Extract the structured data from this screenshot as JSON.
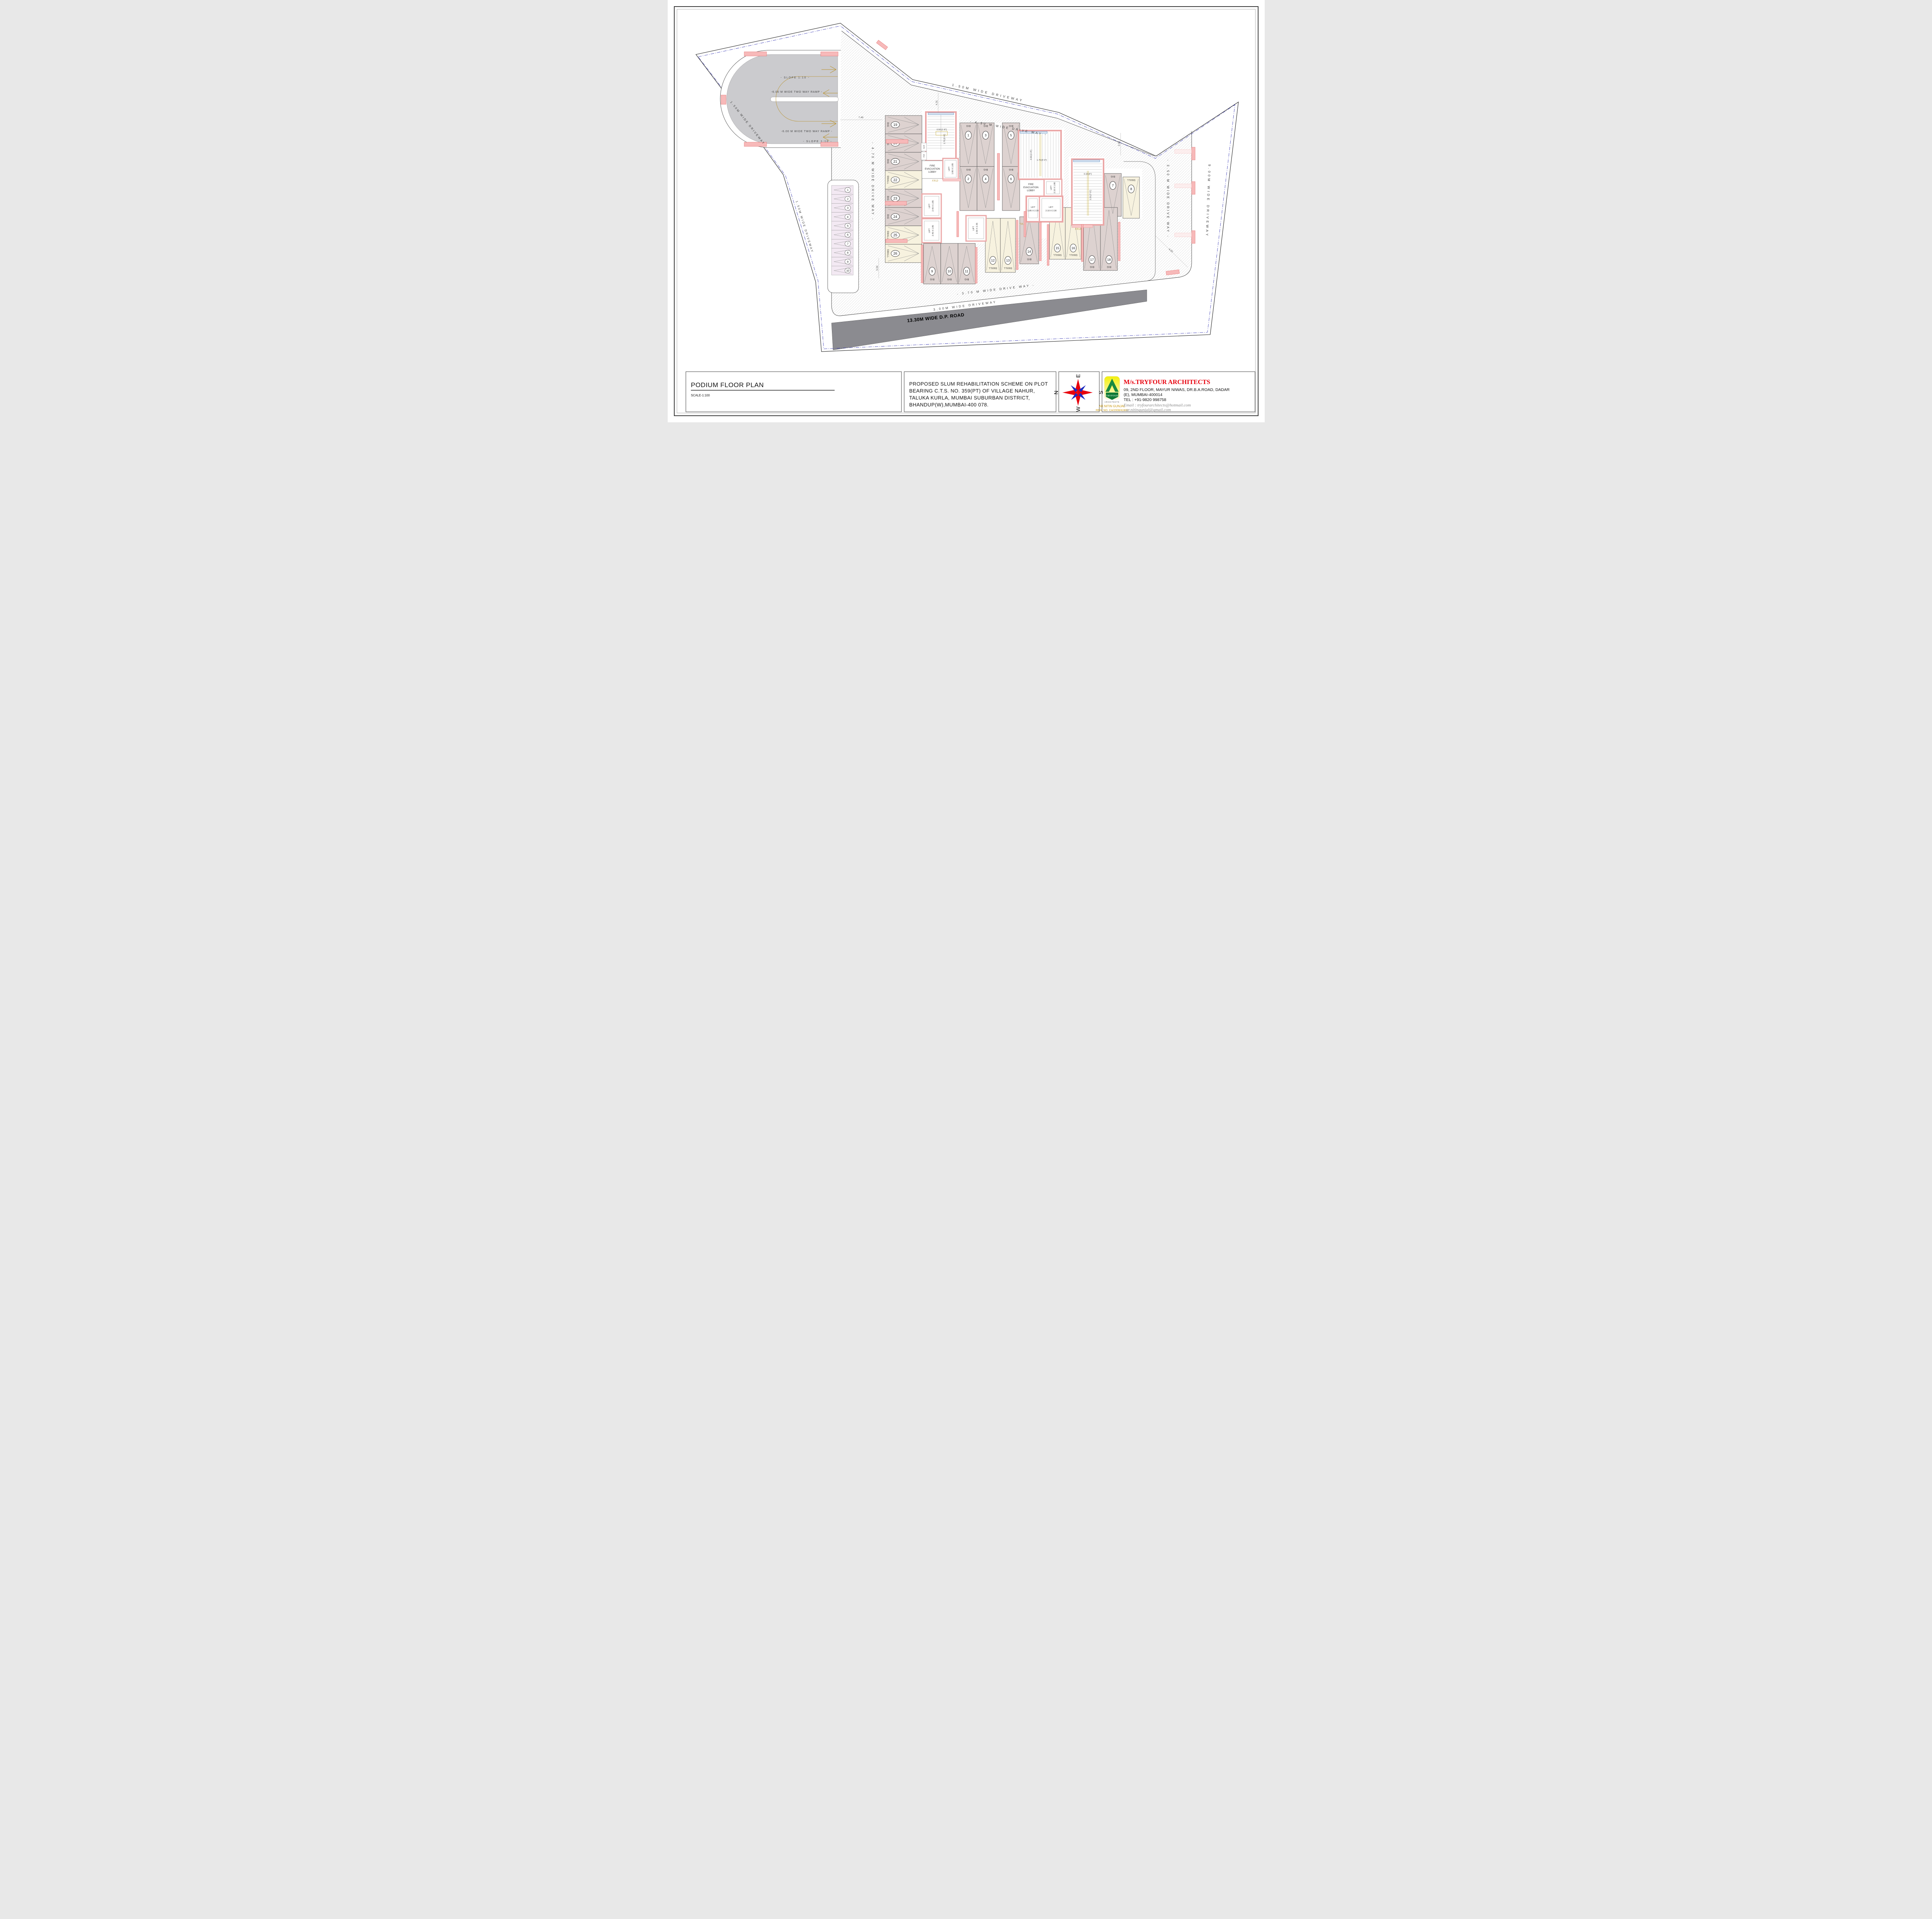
{
  "drawing": {
    "title": "PODIUM FLOOR PLAN",
    "scale": "SCALE-1:100",
    "description_lines": [
      "PROPOSED SLUM REHABILITATION SCHEME ON PLOT",
      "BEARING C.T.S. NO. 359(PT) OF VILLAGE NAHUR,",
      "TALUKA KURLA, MUMBAI SUBURBAN DISTRICT,",
      "BHANDUP(W),MUMBAI-400 078."
    ],
    "compass": {
      "n": "N",
      "e": "E",
      "s": "S",
      "w": "W"
    },
    "architect": {
      "firm": "M/s.TRYFOUR ARCHITECTS",
      "address1": "09, 2ND FLOOR, MAYUR NIWAS, DR.B.A.ROAD, DADAR",
      "address2": "(E), MUMBAI-400014",
      "tel": "TEL        : +91-9820 998758",
      "email1": "Email      : tryfourarchitects@hotmail.com",
      "email2": "             : ar.nitingunjal@gmail.com",
      "logo_title": "TRYFOUR",
      "logo_sub": "ARCHITECTS",
      "author": "AR.NITIN GUNJAL",
      "reg": "REG. NO. CA/2008/42482"
    },
    "colors": {
      "accent_red": "#e8000d",
      "gold": "#c8960c",
      "wall_pink": "#f7b9b9",
      "stall_big": "#ddd2d0",
      "stall_small": "#f7f2df",
      "stall_strip": "#f3e9f3",
      "road_gray": "#8b8b90"
    },
    "plan": {
      "ramp": {
        "slope1": "- SLOPE 1:10 -",
        "label1": "-6.00 M WIDE TWO WAY RAMP -",
        "label2": "-6.00 M WIDE TWO WAY RAMP -",
        "slope2": "- SLOPE 1:10 -"
      },
      "driveways": {
        "top": "1.50M WIDE DRIVEWAY",
        "left_upper": "1.50M WIDE DRIVEWAY",
        "left_lower": "1.50M WIDE DRIVEWAY",
        "d430": "- 4.30 M WIDE DRIVE WAY -",
        "d470": "- 4.70 M WIDE DRIVE WAY -",
        "d350": "- 3.50 M WIDE DRIVE WAY -",
        "d900": "9.00M WIDE DRIVEWAY",
        "d370": "- 3.70 M WIDE DRIVE WAY -",
        "d300": "3.00M WIDE DRIVEWAY",
        "road": "13.30M WIDE D.P. ROAD"
      },
      "cores": {
        "fire1": [
          "FIRE",
          "EVACUATION",
          "LOBBY"
        ],
        "fire2": [
          "FIRE",
          "EVACUATION",
          "LOBBY"
        ],
        "frd": "F.R.D",
        "ed": "E.D",
        "fd": "F.D",
        "lift_word": "LIFT",
        "lift1": "1.80 X 1.85",
        "lift2": "2.40 X 1.85",
        "lift3": "2.40 X 1.85",
        "lift4": "2.30 X 2.35",
        "lift5": "2.10 X 1.80",
        "lift6": "1.85 X 2.30",
        "lift7": "2.10 X 2.30"
      },
      "dims": {
        "d749": "7.49",
        "d431": "4.31",
        "d333": "3.33",
        "d420": "4.20",
        "d550": "5.50",
        "s1a": "0.50 [1'-8\"]",
        "s1b": "1.75 [5'-9\"]",
        "s2a": "0.50 [1'-8\"]",
        "s2b": "1.75 [5'-9\"]",
        "s3a": "0.10 [4\"]",
        "s3b": "2.25 [7'-5\"]"
      },
      "strip": [
        "1",
        "2",
        "3",
        "4",
        "5",
        "6",
        "7",
        "8",
        "9",
        "10"
      ],
      "stalls": [
        {
          "no": "1",
          "size": "BIG"
        },
        {
          "no": "2",
          "size": "BIG"
        },
        {
          "no": "3",
          "size": "BIG"
        },
        {
          "no": "4",
          "size": "BIG"
        },
        {
          "no": "5",
          "size": "BIG"
        },
        {
          "no": "6",
          "size": "BIG"
        },
        {
          "no": "7",
          "size": "BIG"
        },
        {
          "no": "8",
          "size": "SMALL"
        },
        {
          "no": "9",
          "size": "BIG"
        },
        {
          "no": "10",
          "size": "BIG"
        },
        {
          "no": "11",
          "size": "BIG"
        },
        {
          "no": "12",
          "size": "SMALL"
        },
        {
          "no": "13",
          "size": "SMALL"
        },
        {
          "no": "14",
          "size": "BIG"
        },
        {
          "no": "15",
          "size": "SMALL"
        },
        {
          "no": "16",
          "size": "SMALL"
        },
        {
          "no": "17",
          "size": "BIG"
        },
        {
          "no": "18",
          "size": "BIG"
        },
        {
          "no": "19",
          "size": "BIG"
        },
        {
          "no": "20",
          "size": "BIG"
        },
        {
          "no": "21",
          "size": "BIG"
        },
        {
          "no": "22",
          "size": "SMALL"
        },
        {
          "no": "23",
          "size": "BIG"
        },
        {
          "no": "24",
          "size": "BIG"
        },
        {
          "no": "25",
          "size": "SMALL"
        },
        {
          "no": "26",
          "size": "SMALL"
        }
      ]
    }
  }
}
